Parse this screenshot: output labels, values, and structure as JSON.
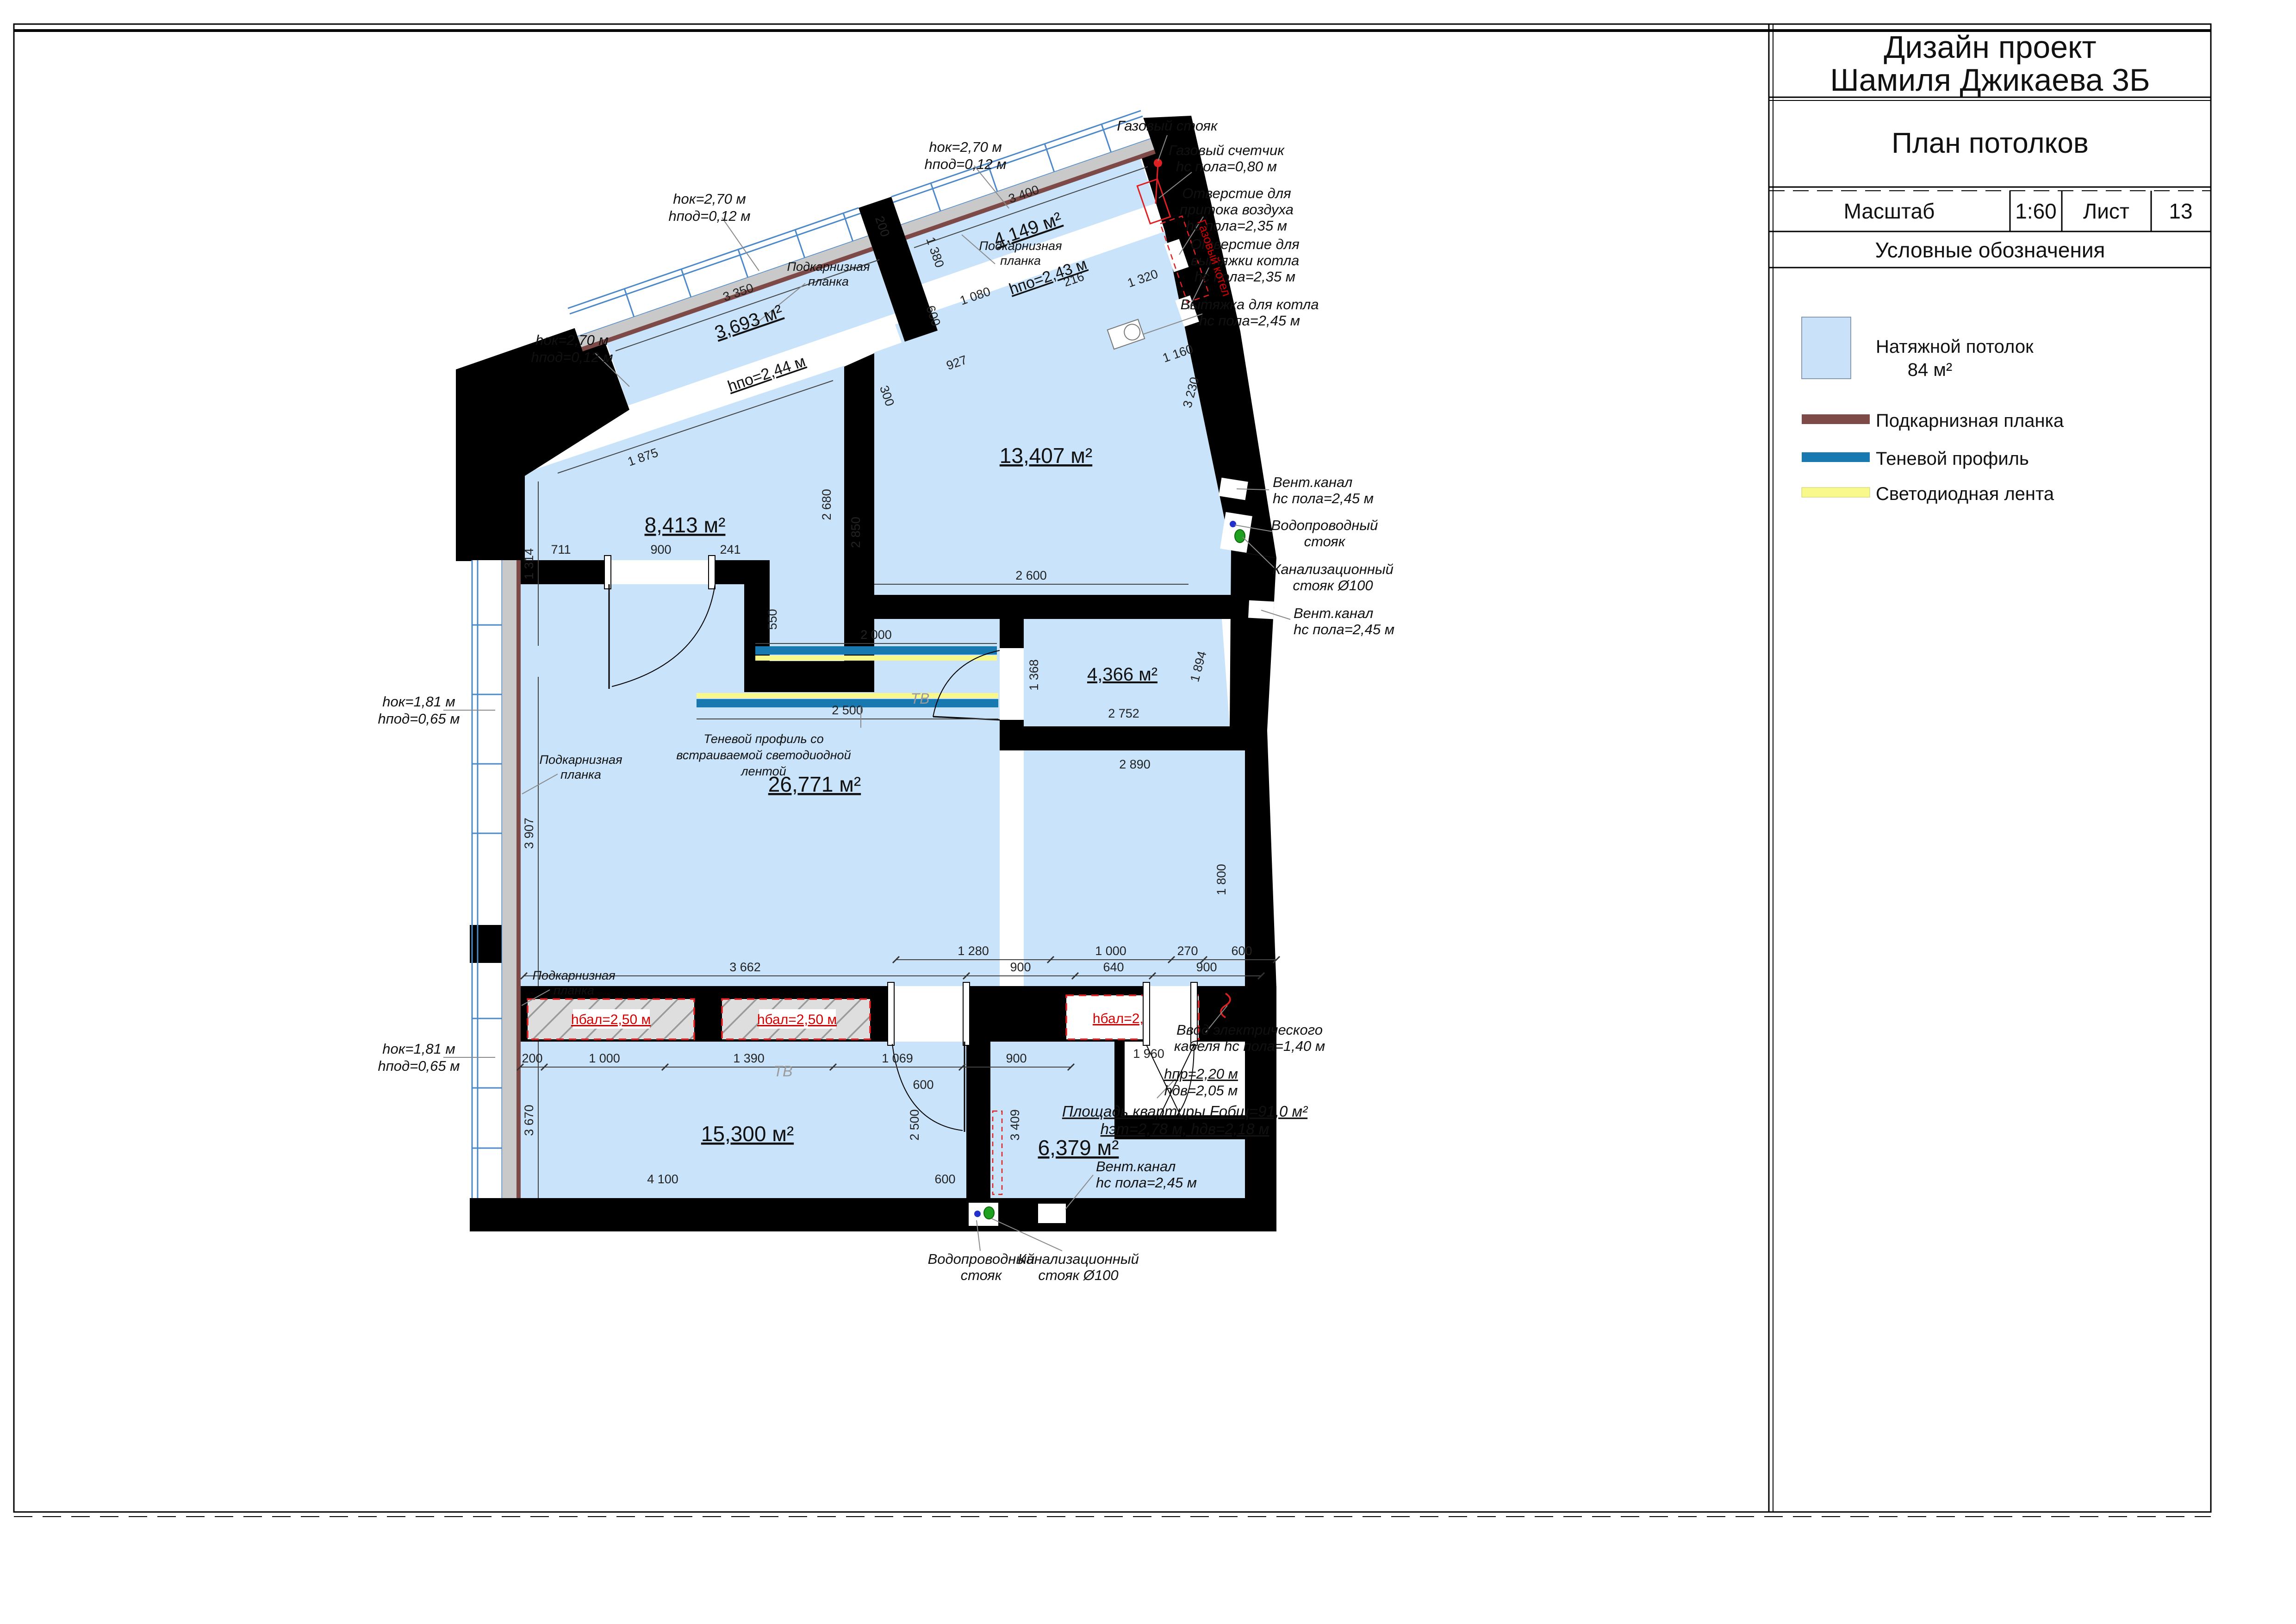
{
  "title_block": {
    "line1": "Дизайн проект",
    "line2": "Шамиля Джикаева 3Б",
    "subtitle": "План потолков",
    "scale_label": "Масштаб",
    "scale_value": "1:60",
    "sheet_label": "Лист",
    "sheet_number": "13",
    "legend_title": "Условные обозначения"
  },
  "legend": {
    "ceiling_label": "Натяжной потолок",
    "ceiling_area": "84 м²",
    "cornice": "Подкарнизная планка",
    "shadow": "Теневой профиль",
    "led": "Светодиодная лента",
    "colors": {
      "ceiling": "#C9E2FA",
      "cornice": "#7E4A48",
      "shadow": "#1878B0",
      "led": "#F9F98B"
    }
  },
  "rooms": {
    "r3693": "3,693 м²",
    "r4149": "4,149 м²",
    "r8413": "8,413 м²",
    "r13407": "13,407 м²",
    "r26771": "26,771 м²",
    "r4366": "4,366 м²",
    "r15300": "15,300 м²",
    "r6379": "6,379 м²"
  },
  "levels": {
    "b244": "hпо=2,44 м",
    "b243": "hпо=2,43 м",
    "beam": "hбал=2,50 м"
  },
  "annotations": {
    "window1_l1": "hок=2,70 м",
    "window1_l2": "hпод=0,12 м",
    "window2_l1": "hок=1,81 м",
    "window2_l2": "hпод=0,65 м",
    "cornice_l1": "Подкарнизная",
    "cornice_l2": "планка",
    "shadow_l1": "Теневой профиль со",
    "shadow_l2": "встраиваемой светодиодной",
    "shadow_l3": "лентой",
    "gas_riser": "Газовый стояк",
    "gas_meter_l1": "Газовый счетчик",
    "gas_meter_l2": "hс пола=0,80 м",
    "air_l1": "Отверстие для",
    "air_l2": "притока воздуха",
    "air_l3": "hс пола=2,35 м",
    "boiler_vent_l1": "Отверстие для",
    "boiler_vent_l2": "вытяжки котла",
    "boiler_vent_l3": "hс пола=2,35 м",
    "boiler_hood_l1": "Вытяжка для котла",
    "boiler_hood_l2": "hс пола=2,45 м",
    "vent_l1": "Вент.канал",
    "vent_l2": "hс пола=2,45 м",
    "water_l1": "Водопроводный",
    "water_l2": "стояк",
    "sewer_l1": "Канализационный",
    "sewer_l2": "стояк Ø100",
    "cable_l1": "Ввод электрического",
    "cable_l2": "кабеля hс пола=1,40 м",
    "door_l1": "hпр=2,20 м",
    "door_l2": "hдв=2,05 м",
    "apt_l1": "Площадь квартиры Fобщ=91,0 м²",
    "apt_l2": "hэт=2,78 м, hдв=2,18 м",
    "boiler_label": "Газовый котел",
    "tv": "ТВ"
  },
  "dims": {
    "k3350": "3 350",
    "k3400": "3 400",
    "k1080": "1 080",
    "k1380": "1 380",
    "k200": "200",
    "k216": "216",
    "k1320": "1 320",
    "k1160": "1 160",
    "k600": "600",
    "k927": "927",
    "k300": "300",
    "k1875": "1 875",
    "k1314": "1 314",
    "k2680": "2 680",
    "k2850": "2 850",
    "k3230": "3 230",
    "k2600": "2 600",
    "k2000": "2 000",
    "k2500": "2 500",
    "k711": "711",
    "k900": "900",
    "k241": "241",
    "k550": "550",
    "k3907": "3 907",
    "k3662": "3 662",
    "k640": "640",
    "k1280": "1 280",
    "k1000": "1 000",
    "k270": "270",
    "k1390": "1 390",
    "k1069": "1 069",
    "k1960": "1 960",
    "k3670": "3 670",
    "k3409": "3 409",
    "k4100": "4 100",
    "k1368": "1 368",
    "k1894": "1 894",
    "k2752": "2 752",
    "k2890": "2 890",
    "k1800": "1 800"
  }
}
